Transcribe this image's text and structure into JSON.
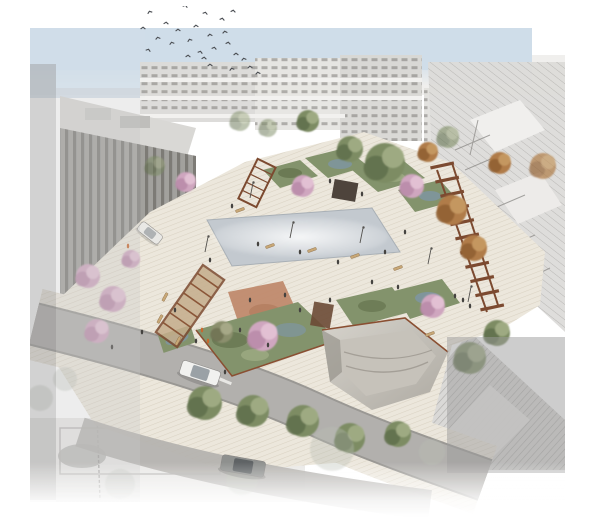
{
  "meta": {
    "title": "Aerial rendering of a renovated public square with pergolas, cherry trees and a reflecting pool"
  },
  "palette": {
    "paper": "#ffffff",
    "sky": "#cfdde9",
    "band": "#eeedeb",
    "paving": "#ece7dc",
    "paving_stripe": "#dad2c3",
    "asphalt": "#b2b0ad",
    "asphalt_edge": "#9a9894",
    "crosswalk": "#f2f1ee",
    "wood": "#7c4a30",
    "wood_roof": "#c5ad8c",
    "corten": "#8a4f32",
    "pool": "#c3c9cf",
    "pool_edge": "#a9b0b6",
    "garden": "#83936c",
    "garden_dark": "#65744f",
    "garden_blue": "#7e96ab",
    "garden_light": "#9dab83",
    "playground": "#c08a6d",
    "kiosk": "#4e443c",
    "shed": "#6b4a35",
    "bowl_light": "#d6d3cc",
    "bowl_dark": "#aeaaa2",
    "bowl_inner": "#c6c2ba",
    "bowl_shadow": "#8e8a82",
    "facade_a": "#dcdbd8",
    "facade_b": "#e6e5e2",
    "facade_c": "#d8d7d4",
    "window": "#6f6d6a",
    "brutalist": "#9e9c98",
    "brutalist_roof": "#d7d6d3",
    "hatch_line": "#a9a7a4",
    "overlay_gray": "#9c9c9c",
    "overlay_light": "#c6c6c6",
    "figure": "#44423f",
    "bench": "#c8a877",
    "bird": "#4a4d52",
    "trees": {
      "pink": {
        "base": "#cfa6bf",
        "dark": "#b98aa8",
        "light": "#e3c3d5"
      },
      "green": {
        "base": "#7d8c64",
        "dark": "#5f6e4b",
        "light": "#a2ad85"
      },
      "autumn": {
        "base": "#b07c48",
        "dark": "#8f5f33",
        "light": "#c79a63"
      },
      "olive": {
        "base": "#8b8f6d",
        "dark": "#6e7253",
        "light": "#a8ab8a"
      },
      "ghost": {
        "base": "#b9beb2",
        "dark": "#b9beb2",
        "light": "#c9cec2"
      }
    }
  },
  "scene": {
    "birds": [
      [
        150,
        13
      ],
      [
        185,
        7
      ],
      [
        205,
        14
      ],
      [
        222,
        20
      ],
      [
        233,
        12
      ],
      [
        166,
        24
      ],
      [
        143,
        29
      ],
      [
        178,
        31
      ],
      [
        196,
        27
      ],
      [
        210,
        36
      ],
      [
        225,
        33
      ],
      [
        158,
        39
      ],
      [
        172,
        44
      ],
      [
        190,
        41
      ],
      [
        148,
        51
      ],
      [
        200,
        53
      ],
      [
        214,
        49
      ],
      [
        228,
        44
      ],
      [
        204,
        59
      ],
      [
        188,
        57
      ],
      [
        236,
        55
      ],
      [
        210,
        66
      ],
      [
        250,
        68
      ],
      [
        258,
        74
      ],
      [
        244,
        60
      ],
      [
        232,
        70
      ]
    ],
    "trees": [
      {
        "t": "pink",
        "x": 88,
        "y": 276,
        "r": 12
      },
      {
        "t": "pink",
        "x": 113,
        "y": 299,
        "r": 13
      },
      {
        "t": "pink",
        "x": 97,
        "y": 331,
        "r": 12
      },
      {
        "t": "pink",
        "x": 131,
        "y": 259,
        "r": 9
      },
      {
        "t": "pink",
        "x": 186,
        "y": 182,
        "r": 10
      },
      {
        "t": "pink",
        "x": 303,
        "y": 186,
        "r": 11
      },
      {
        "t": "pink",
        "x": 412,
        "y": 186,
        "r": 12
      },
      {
        "t": "pink",
        "x": 263,
        "y": 336,
        "r": 15
      },
      {
        "t": "pink",
        "x": 433,
        "y": 306,
        "r": 12
      },
      {
        "t": "green",
        "x": 385,
        "y": 163,
        "r": 20
      },
      {
        "t": "green",
        "x": 350,
        "y": 149,
        "r": 13
      },
      {
        "t": "green",
        "x": 308,
        "y": 121,
        "r": 11
      },
      {
        "t": "green",
        "x": 470,
        "y": 358,
        "r": 16
      },
      {
        "t": "green",
        "x": 497,
        "y": 333,
        "r": 13
      },
      {
        "t": "green",
        "x": 205,
        "y": 403,
        "r": 17
      },
      {
        "t": "green",
        "x": 253,
        "y": 411,
        "r": 16
      },
      {
        "t": "green",
        "x": 303,
        "y": 421,
        "r": 16
      },
      {
        "t": "green",
        "x": 350,
        "y": 438,
        "r": 15
      },
      {
        "t": "green",
        "x": 398,
        "y": 434,
        "r": 13
      },
      {
        "t": "green",
        "x": 155,
        "y": 166,
        "r": 10,
        "o": 0.55
      },
      {
        "t": "green",
        "x": 240,
        "y": 121,
        "r": 10,
        "o": 0.5
      },
      {
        "t": "green",
        "x": 268,
        "y": 128,
        "r": 9,
        "o": 0.5
      },
      {
        "t": "green",
        "x": 448,
        "y": 137,
        "r": 11,
        "o": 0.6
      },
      {
        "t": "olive",
        "x": 222,
        "y": 332,
        "r": 11
      },
      {
        "t": "autumn",
        "x": 452,
        "y": 210,
        "r": 15
      },
      {
        "t": "autumn",
        "x": 474,
        "y": 248,
        "r": 13
      },
      {
        "t": "autumn",
        "x": 500,
        "y": 163,
        "r": 11
      },
      {
        "t": "autumn",
        "x": 428,
        "y": 152,
        "r": 10
      },
      {
        "t": "autumn",
        "x": 543,
        "y": 166,
        "r": 13,
        "o": 0.7
      },
      {
        "t": "ghost",
        "x": 332,
        "y": 449,
        "r": 22
      },
      {
        "t": "ghost",
        "x": 242,
        "y": 479,
        "r": 16
      },
      {
        "t": "ghost",
        "x": 120,
        "y": 484,
        "r": 15
      },
      {
        "t": "ghost",
        "x": 40,
        "y": 398,
        "r": 13
      },
      {
        "t": "ghost",
        "x": 65,
        "y": 379,
        "r": 12
      },
      {
        "t": "ghost",
        "x": 432,
        "y": 452,
        "r": 13
      }
    ],
    "people": [
      [
        232,
        206
      ],
      [
        258,
        244
      ],
      [
        300,
        252
      ],
      [
        338,
        262
      ],
      [
        372,
        282
      ],
      [
        398,
        287
      ],
      [
        300,
        310
      ],
      [
        268,
        345
      ],
      [
        240,
        330
      ],
      [
        196,
        341
      ],
      [
        142,
        332
      ],
      [
        405,
        232
      ],
      [
        362,
        194
      ],
      [
        330,
        181
      ],
      [
        455,
        296
      ],
      [
        463,
        300
      ],
      [
        470,
        306
      ],
      [
        225,
        372
      ],
      [
        112,
        347
      ],
      [
        250,
        300
      ],
      [
        285,
        295
      ],
      [
        385,
        252
      ],
      [
        330,
        300
      ],
      [
        210,
        260
      ],
      [
        175,
        310
      ],
      [
        202,
        330,
        "#c9672f"
      ],
      [
        208,
        341,
        "#c9672f"
      ],
      [
        128,
        246,
        "#c9672f"
      ]
    ],
    "lamps": [
      [
        250,
        198
      ],
      [
        290,
        238
      ],
      [
        360,
        243
      ],
      [
        428,
        264
      ],
      [
        468,
        302
      ],
      [
        205,
        252
      ]
    ],
    "benches": [
      [
        312,
        250,
        -20
      ],
      [
        355,
        256,
        -20
      ],
      [
        398,
        268,
        -20
      ],
      [
        270,
        246,
        -20
      ],
      [
        165,
        297,
        -62
      ],
      [
        160,
        319,
        -62
      ],
      [
        240,
        210,
        -20
      ],
      [
        430,
        334,
        -20
      ],
      [
        178,
        341,
        -62
      ]
    ],
    "cars": [
      {
        "x": 200,
        "y": 373,
        "rot": 18,
        "w": 40,
        "h": 15,
        "body": "#f1f1ef",
        "glass": "#9aa1a6",
        "o": 1
      },
      {
        "x": 243,
        "y": 466,
        "rot": 10,
        "w": 44,
        "h": 16,
        "body": "#8e908e",
        "glass": "#5f6365",
        "o": 1
      },
      {
        "x": 150,
        "y": 233,
        "rot": 38,
        "w": 26,
        "h": 11,
        "body": "#e9e9e7",
        "glass": "#a9adb0",
        "o": 0.9
      }
    ],
    "pergola_chain": {
      "x1": 437,
      "y1": 170,
      "x2": 487,
      "y2": 312,
      "bars": 11,
      "len": 24,
      "tilt": -12
    }
  }
}
